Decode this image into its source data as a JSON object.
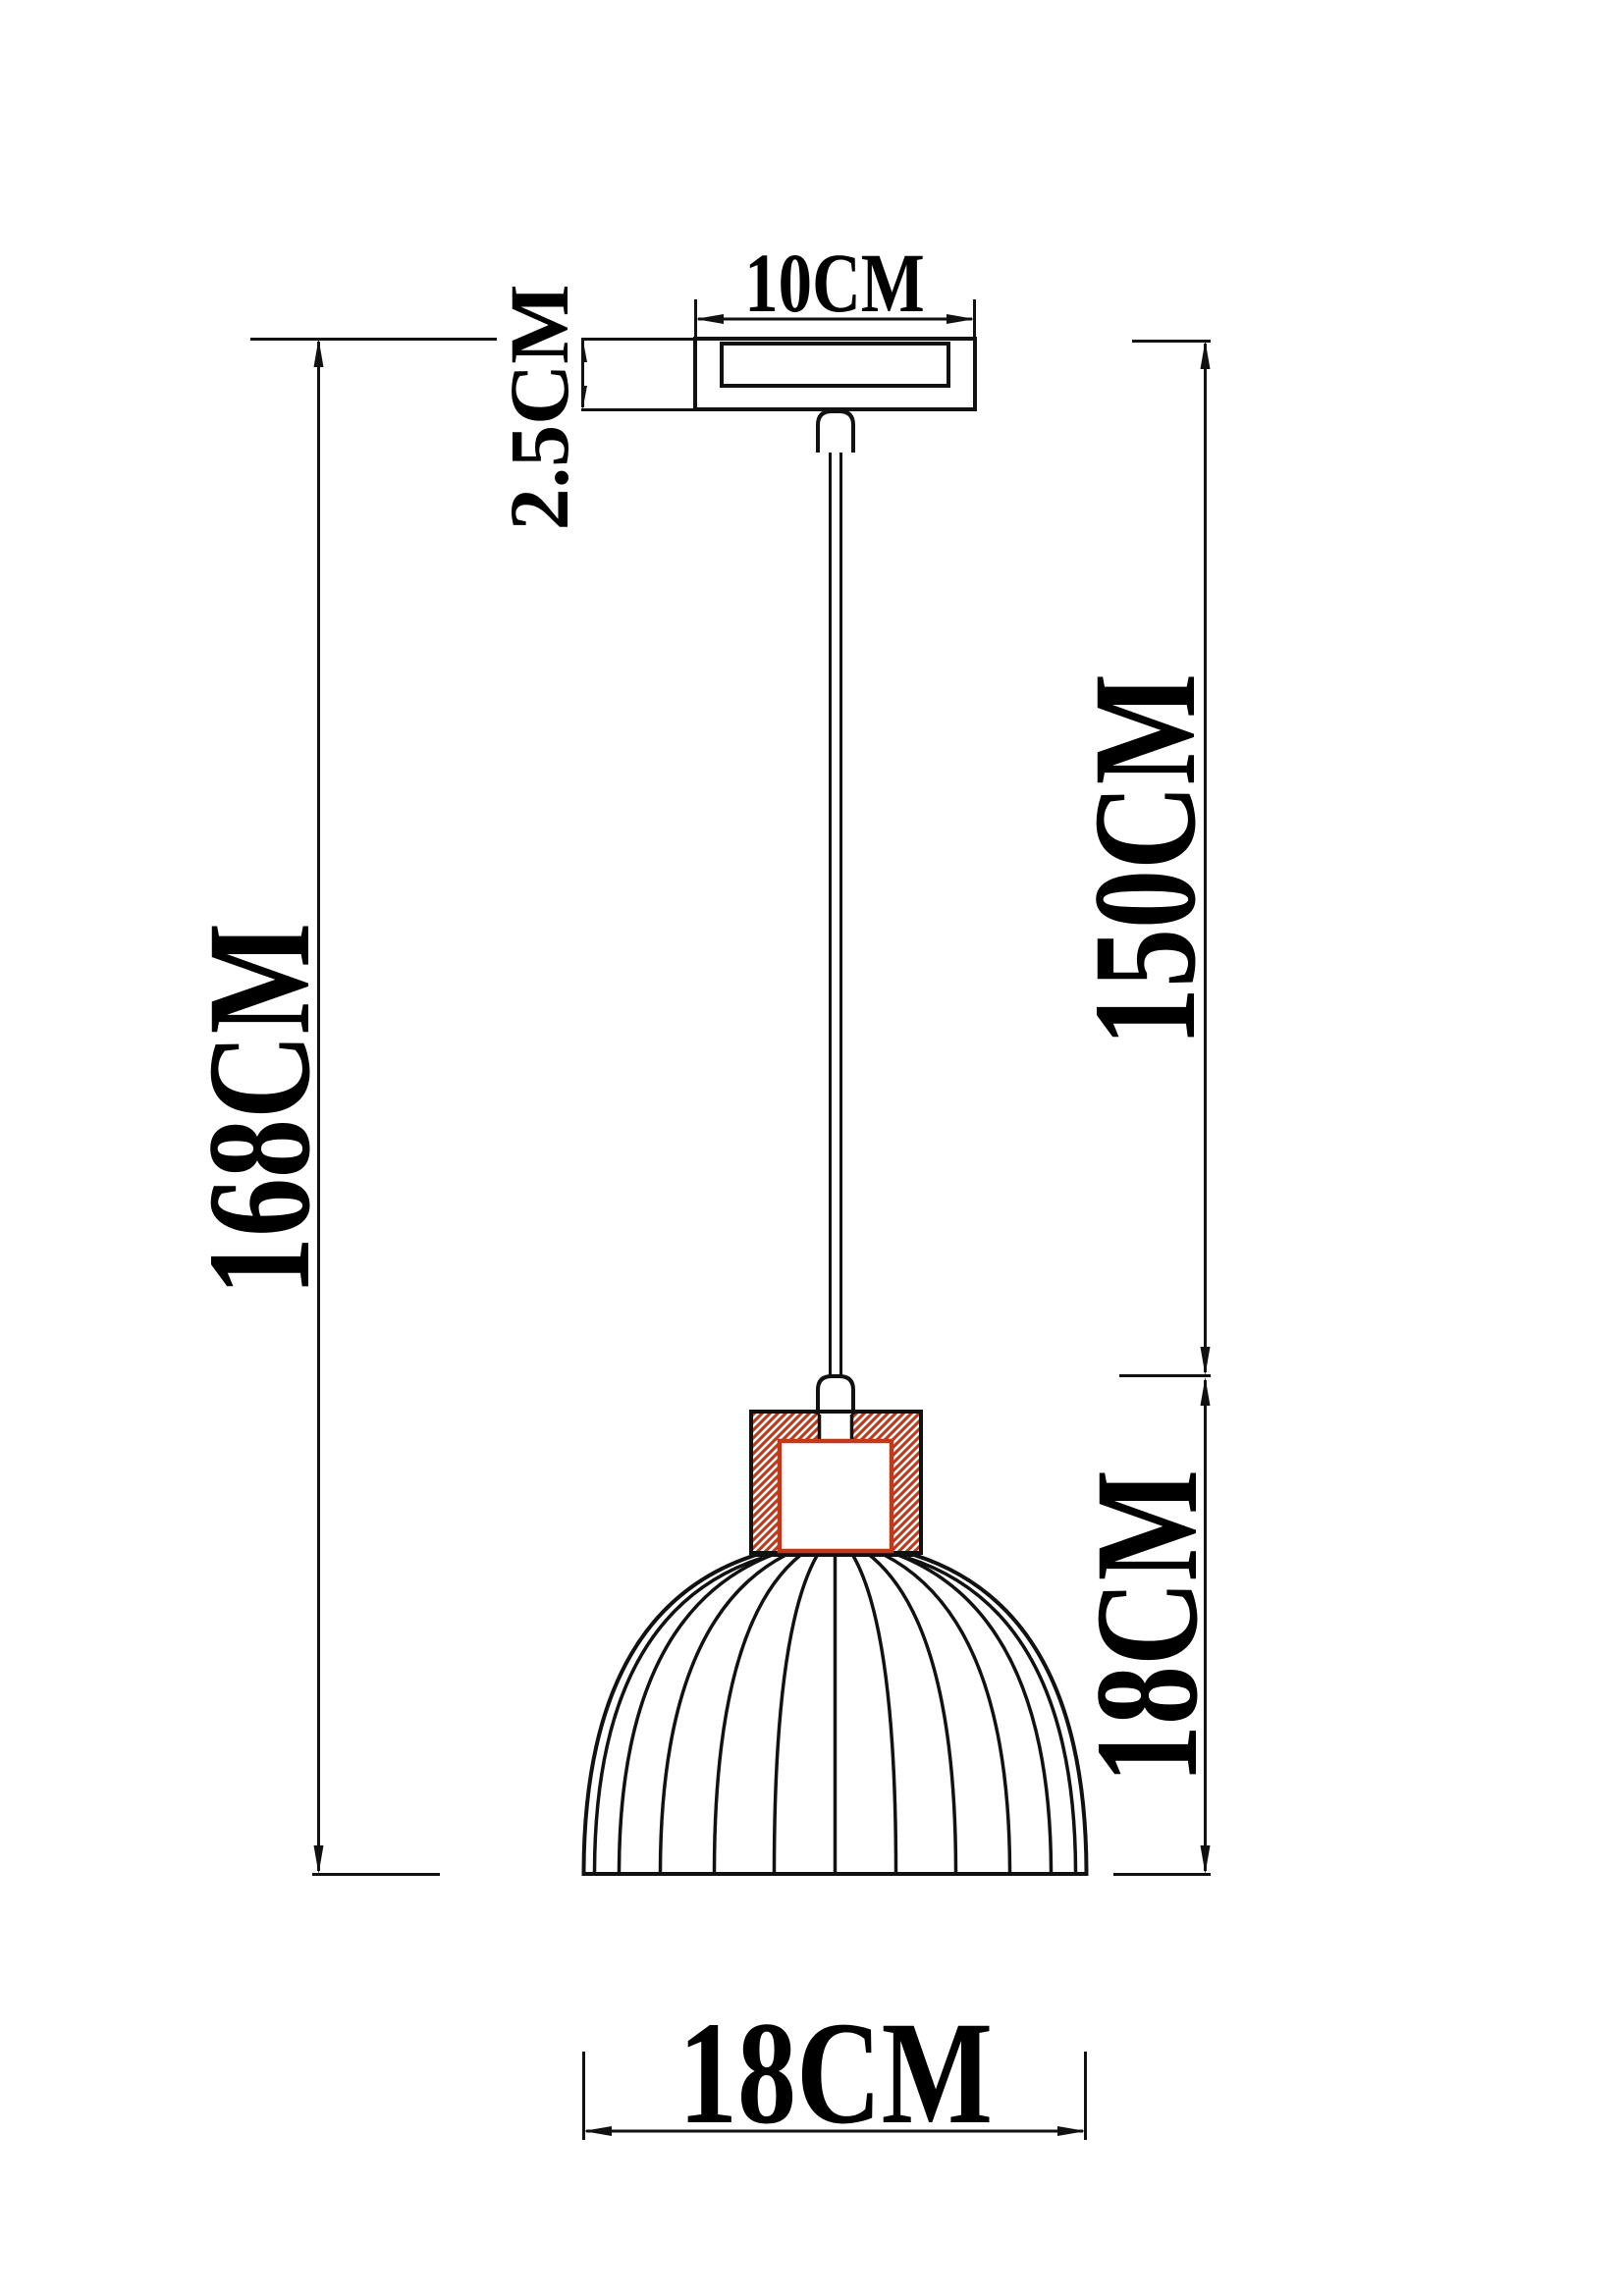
{
  "meta": {
    "type": "technical-dimension-drawing",
    "subject": "pendant lamp with ribbed dome shade and wooden socket cup"
  },
  "colors": {
    "line": "#111111",
    "wood_hatch": "#c0391b",
    "background": "#ffffff"
  },
  "labels": {
    "canopy_width": "10CM",
    "canopy_height": "2.5CM",
    "total_height": "168CM",
    "cord_length": "150CM",
    "shade_height": "18CM",
    "shade_diameter": "18CM"
  }
}
